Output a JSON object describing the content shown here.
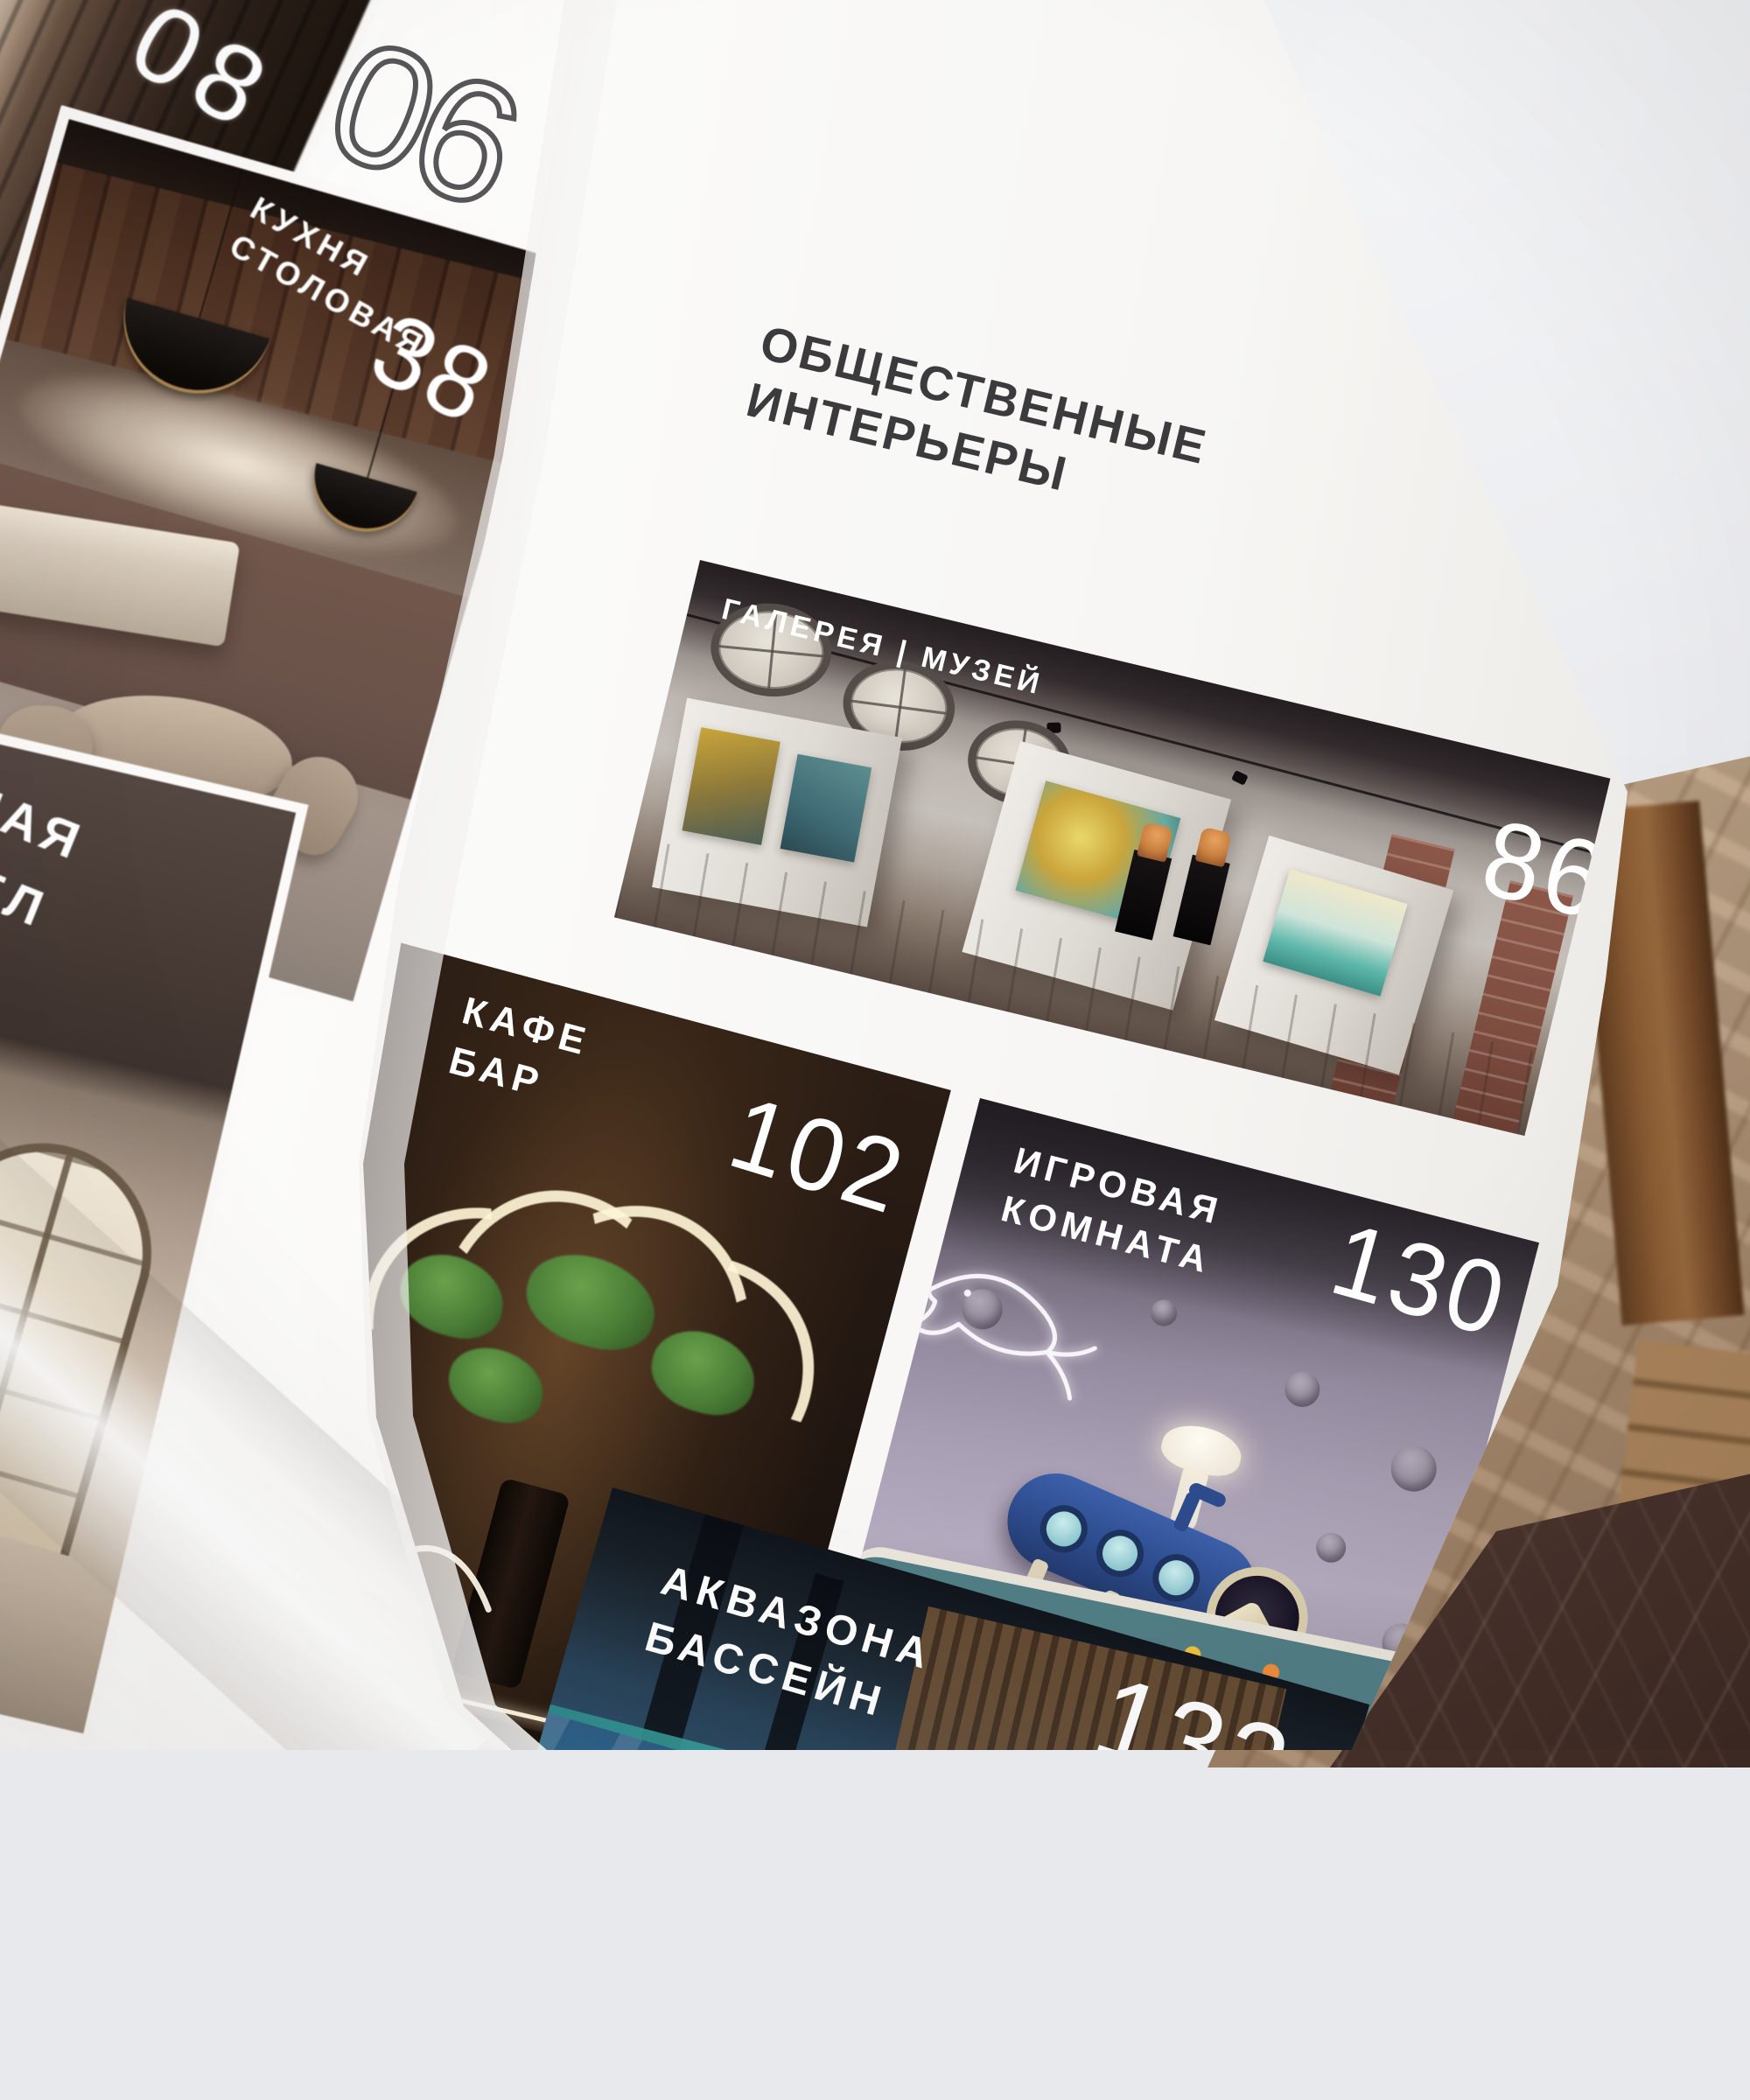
{
  "left_page": {
    "top_tile_number": "08",
    "section_number": "06",
    "kitchen": {
      "label_line1": "КУХНЯ",
      "label_line2": "СТОЛОВАЯ",
      "page_number": "38"
    },
    "bathroom": {
      "label_line1": "НАЯ",
      "label_line2": "ЗЕЛ"
    }
  },
  "right_page": {
    "title_line1": "ОБЩЕСТВЕННЫЕ",
    "title_line2": "ИНТЕРЬЕРЫ",
    "gallery": {
      "label": "ГАЛЕРЕЯ | МУЗЕЙ",
      "page_number": "86"
    },
    "cafe": {
      "label_line1": "КАФЕ",
      "label_line2": "БАР",
      "page_number": "102"
    },
    "playroom": {
      "label_line1": "ИГРОВАЯ",
      "label_line2": "КОМНАТА",
      "page_number": "130"
    },
    "aquazone": {
      "label_line1": "АКВАЗОНА",
      "label_line2": "БАССЕЙН",
      "page_number": "132"
    }
  },
  "colors": {
    "background": "#e8e9ec",
    "page": "#f9f8f6",
    "title_text": "#3b3b3d",
    "label_text": "#ffffff",
    "number_text": "#ffffff",
    "outline_number_stroke": "#3f3f42",
    "wood_table": "#b59a7e",
    "marble": "#46302a"
  }
}
